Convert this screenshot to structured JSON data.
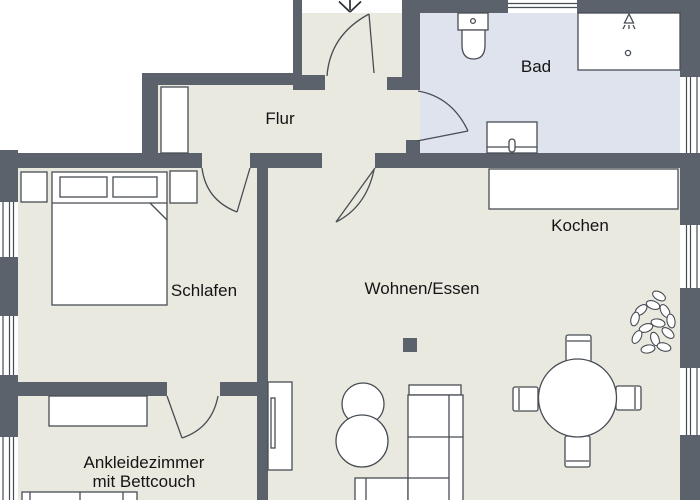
{
  "plan": {
    "title": "apartment-floor-plan",
    "rooms": {
      "flur": {
        "label": "Flur"
      },
      "bad": {
        "label": "Bad"
      },
      "kochen": {
        "label": "Kochen"
      },
      "schlafen": {
        "label": "Schlafen"
      },
      "wohnen": {
        "label": "Wohnen/Essen"
      },
      "ankleide": {
        "label_line1": "Ankleidezimmer",
        "label_line2": "mit Bettcouch"
      }
    },
    "colors": {
      "wall": "#5b626b",
      "floor": "#eae9e0",
      "bathroom_floor": "#dee3ed",
      "furniture_fill": "#ffffff",
      "outline": "#474d54",
      "text": "#141414",
      "outside": "#ffffff"
    },
    "markers": {
      "entrance_arrow": "down-arrow"
    },
    "furniture": [
      {
        "room": "Flur",
        "items": [
          "closet"
        ]
      },
      {
        "room": "Bad",
        "items": [
          "toilet",
          "shower",
          "sink-vanity"
        ]
      },
      {
        "room": "Kochen",
        "items": [
          "kitchen-counter"
        ]
      },
      {
        "room": "Schlafen",
        "items": [
          "double-bed",
          "pillow",
          "pillow",
          "nightstand-left",
          "nightstand-right"
        ]
      },
      {
        "room": "Wohnen/Essen",
        "items": [
          "corner-sofa",
          "side-table-round",
          "side-table-round",
          "tv-board",
          "dining-table-round",
          "chair",
          "chair",
          "chair",
          "chair",
          "plant",
          "column"
        ]
      },
      {
        "room": "Ankleidezimmer",
        "items": [
          "dresser",
          "bed-couch"
        ]
      }
    ],
    "doors": [
      "entrance-door",
      "bad-door",
      "schlafen-door",
      "wohnen-door",
      "ankleide-door"
    ],
    "windows_count": 7
  }
}
